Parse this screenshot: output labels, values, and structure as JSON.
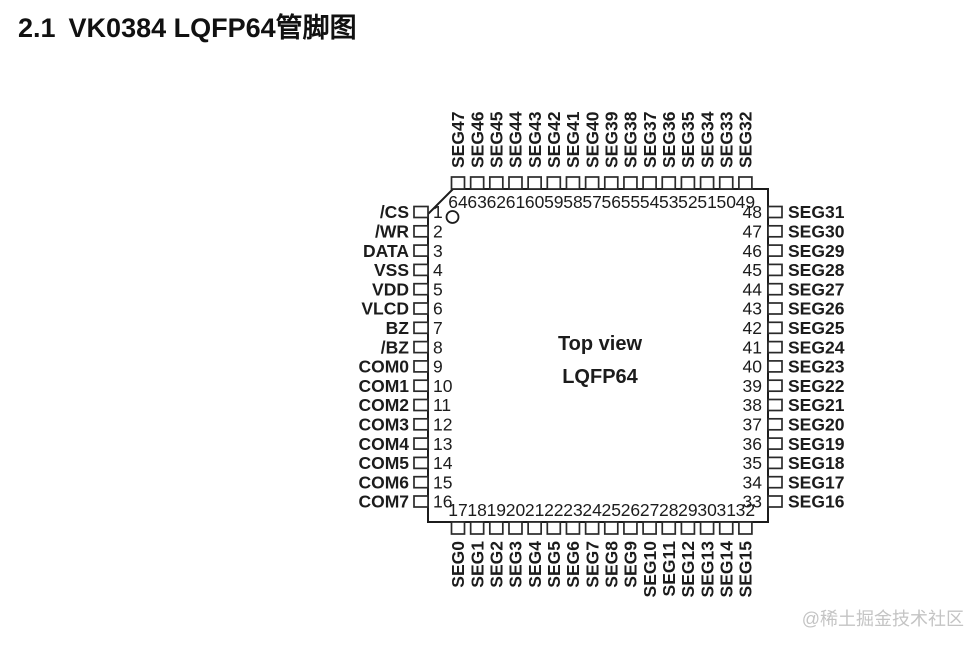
{
  "title": {
    "number": "2.1",
    "text": "VK0384 LQFP64管脚图"
  },
  "chip": {
    "view_label": "Top view",
    "package_label": "LQFP64"
  },
  "pins": {
    "left": [
      {
        "num": "1",
        "name": "/CS"
      },
      {
        "num": "2",
        "name": "/WR"
      },
      {
        "num": "3",
        "name": "DATA"
      },
      {
        "num": "4",
        "name": "VSS"
      },
      {
        "num": "5",
        "name": "VDD"
      },
      {
        "num": "6",
        "name": "VLCD"
      },
      {
        "num": "7",
        "name": "BZ"
      },
      {
        "num": "8",
        "name": "/BZ"
      },
      {
        "num": "9",
        "name": "COM0"
      },
      {
        "num": "10",
        "name": "COM1"
      },
      {
        "num": "11",
        "name": "COM2"
      },
      {
        "num": "12",
        "name": "COM3"
      },
      {
        "num": "13",
        "name": "COM4"
      },
      {
        "num": "14",
        "name": "COM5"
      },
      {
        "num": "15",
        "name": "COM6"
      },
      {
        "num": "16",
        "name": "COM7"
      }
    ],
    "top": [
      {
        "num": "64",
        "name": "SEG47"
      },
      {
        "num": "63",
        "name": "SEG46"
      },
      {
        "num": "62",
        "name": "SEG45"
      },
      {
        "num": "61",
        "name": "SEG44"
      },
      {
        "num": "60",
        "name": "SEG43"
      },
      {
        "num": "59",
        "name": "SEG42"
      },
      {
        "num": "58",
        "name": "SEG41"
      },
      {
        "num": "57",
        "name": "SEG40"
      },
      {
        "num": "56",
        "name": "SEG39"
      },
      {
        "num": "55",
        "name": "SEG38"
      },
      {
        "num": "54",
        "name": "SEG37"
      },
      {
        "num": "53",
        "name": "SEG36"
      },
      {
        "num": "52",
        "name": "SEG35"
      },
      {
        "num": "51",
        "name": "SEG34"
      },
      {
        "num": "50",
        "name": "SEG33"
      },
      {
        "num": "49",
        "name": "SEG32"
      }
    ],
    "right": [
      {
        "num": "48",
        "name": "SEG31"
      },
      {
        "num": "47",
        "name": "SEG30"
      },
      {
        "num": "46",
        "name": "SEG29"
      },
      {
        "num": "45",
        "name": "SEG28"
      },
      {
        "num": "44",
        "name": "SEG27"
      },
      {
        "num": "43",
        "name": "SEG26"
      },
      {
        "num": "42",
        "name": "SEG25"
      },
      {
        "num": "41",
        "name": "SEG24"
      },
      {
        "num": "40",
        "name": "SEG23"
      },
      {
        "num": "39",
        "name": "SEG22"
      },
      {
        "num": "38",
        "name": "SEG21"
      },
      {
        "num": "37",
        "name": "SEG20"
      },
      {
        "num": "36",
        "name": "SEG19"
      },
      {
        "num": "35",
        "name": "SEG18"
      },
      {
        "num": "34",
        "name": "SEG17"
      },
      {
        "num": "33",
        "name": "SEG16"
      }
    ],
    "bottom": [
      {
        "num": "17",
        "name": "SEG0"
      },
      {
        "num": "18",
        "name": "SEG1"
      },
      {
        "num": "19",
        "name": "SEG2"
      },
      {
        "num": "20",
        "name": "SEG3"
      },
      {
        "num": "21",
        "name": "SEG4"
      },
      {
        "num": "22",
        "name": "SEG5"
      },
      {
        "num": "23",
        "name": "SEG6"
      },
      {
        "num": "24",
        "name": "SEG7"
      },
      {
        "num": "25",
        "name": "SEG8"
      },
      {
        "num": "26",
        "name": "SEG9"
      },
      {
        "num": "27",
        "name": "SEG10"
      },
      {
        "num": "28",
        "name": "SEG11"
      },
      {
        "num": "29",
        "name": "SEG12"
      },
      {
        "num": "30",
        "name": "SEG13"
      },
      {
        "num": "31",
        "name": "SEG14"
      },
      {
        "num": "32",
        "name": "SEG15"
      }
    ]
  },
  "watermark": "@稀土掘金技术社区",
  "colors": {
    "ink": "#1c1c1c",
    "watermark": "#c4c4c4"
  }
}
